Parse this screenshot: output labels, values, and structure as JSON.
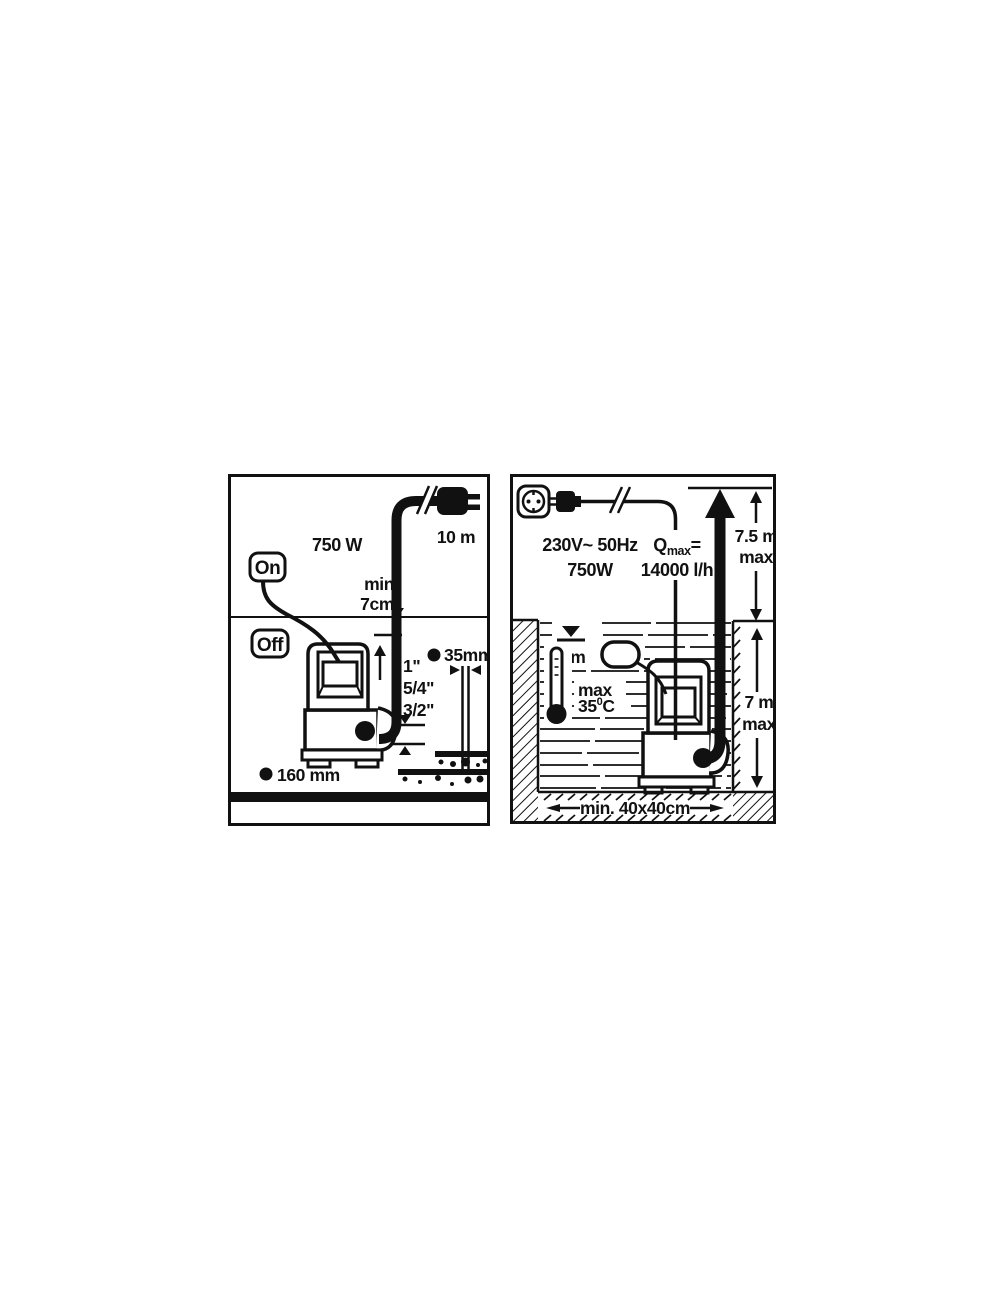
{
  "colors": {
    "ink": "#111111",
    "paper": "#ffffff"
  },
  "left_panel": {
    "power_rating": "750 W",
    "cable_length": "10 m",
    "on_label": "On",
    "off_label": "Off",
    "min_water_depth_line1": "min",
    "min_water_depth_line2": "7cm",
    "thread_sizes": [
      "1\"",
      "5/4\"",
      "3/2\""
    ],
    "hose_diameter_label": "35mm",
    "pump_footprint_label": "160 mm"
  },
  "right_panel": {
    "mains_line1": "230V~ 50Hz",
    "mains_line2": "750W",
    "qmax_symbol": "Q",
    "qmax_subscript": "max",
    "qmax_equals": "=",
    "qmax_value": "14000 l/h",
    "delivery_head_value": "7.5 m",
    "delivery_head_qualifier": "max",
    "switch_on_level": "7 m",
    "water_temp_qualifier": "max",
    "water_temp_value": "35",
    "water_temp_degree": "0",
    "water_temp_unit": "C",
    "immersion_depth_value": "7 m",
    "immersion_depth_qualifier": "max",
    "pit_min_size": "min. 40x40cm"
  }
}
